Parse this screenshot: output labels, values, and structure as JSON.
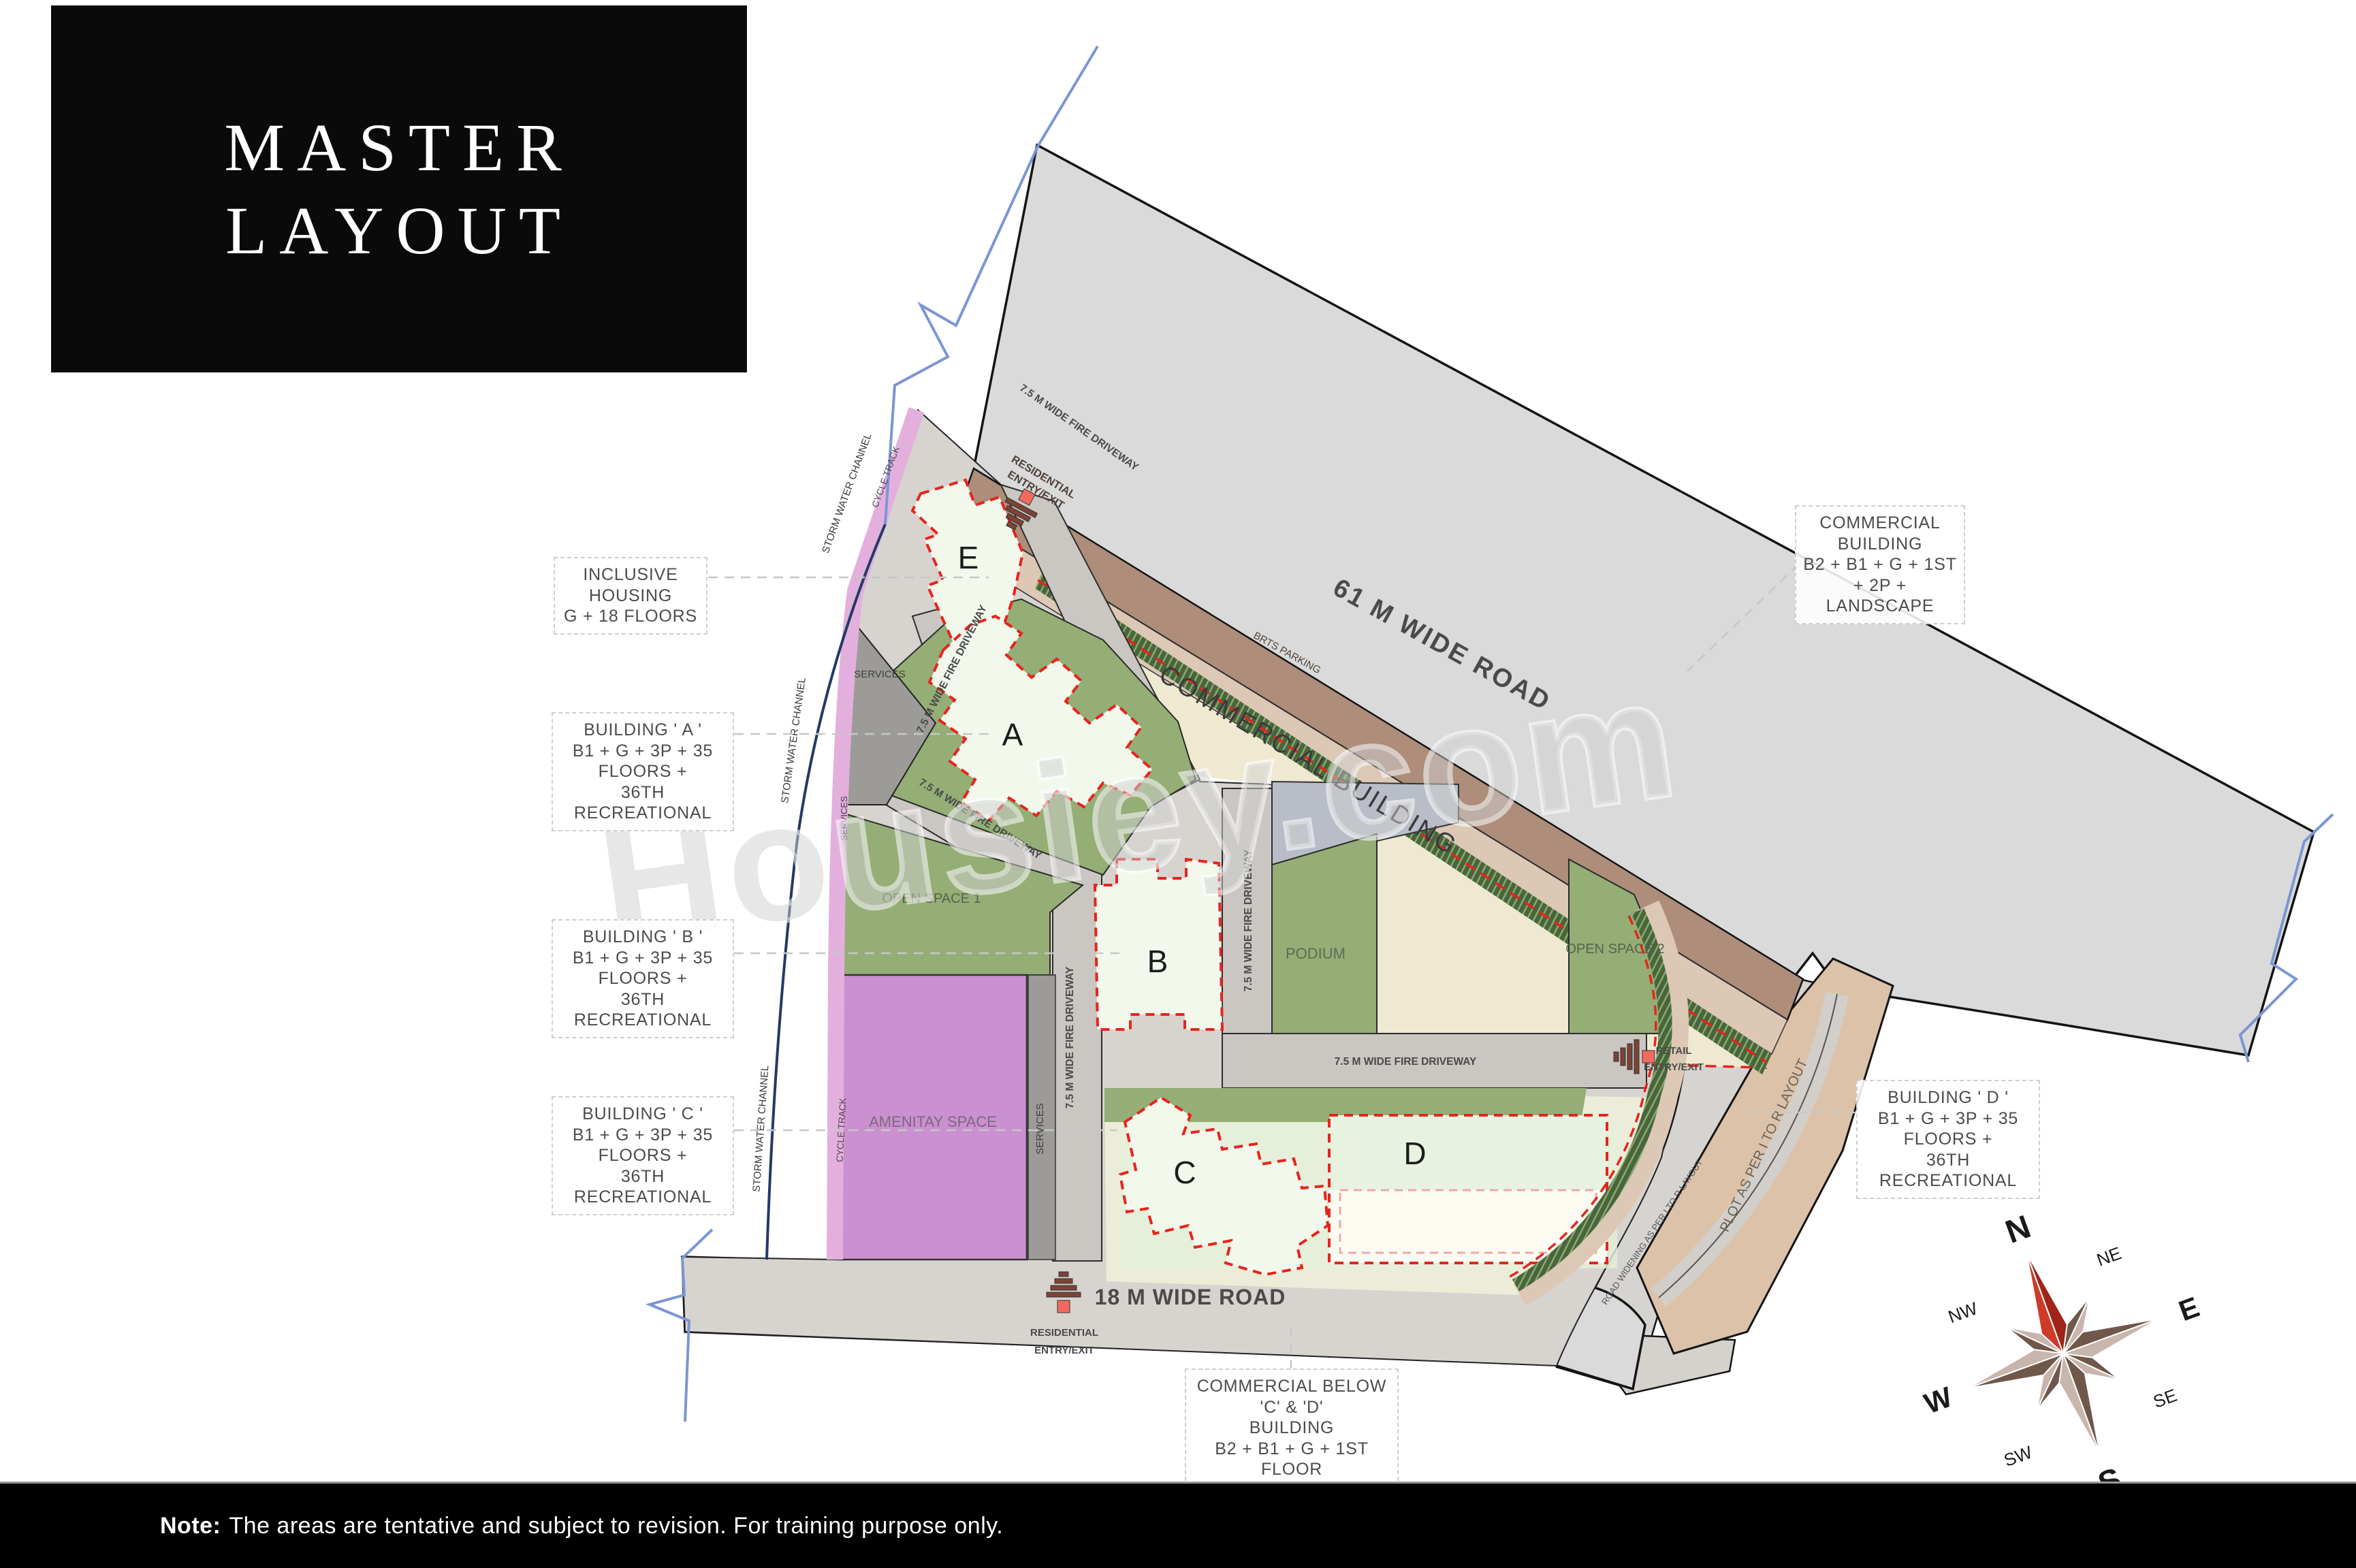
{
  "title": {
    "line1": "MASTER",
    "line2": "LAYOUT"
  },
  "note": {
    "label": "Note:",
    "text": "The areas are tentative and subject to revision. For training purpose only."
  },
  "watermark": "Housiey.com",
  "callouts": {
    "inclusive_housing": {
      "line1": "INCLUSIVE HOUSING",
      "line2": "G + 18 FLOORS"
    },
    "building_a": {
      "line1": "BUILDING ' A '",
      "line2": "B1 + G + 3P + 35 FLOORS +",
      "line3": "36TH RECREATIONAL"
    },
    "building_b": {
      "line1": "BUILDING ' B '",
      "line2": "B1 + G + 3P + 35 FLOORS +",
      "line3": "36TH RECREATIONAL"
    },
    "building_c": {
      "line1": "BUILDING ' C '",
      "line2": "B1 + G + 3P + 35 FLOORS +",
      "line3": "36TH RECREATIONAL"
    },
    "building_d": {
      "line1": "BUILDING ' D '",
      "line2": "B1 + G + 3P + 35 FLOORS +",
      "line3": "36TH RECREATIONAL"
    },
    "commercial": {
      "line1": "COMMERCIAL BUILDING",
      "line2": "B2 + B1 + G + 1ST + 2P +",
      "line3": "LANDSCAPE"
    },
    "commercial_below": {
      "line1": "COMMERCIAL BELOW 'C' & 'D'",
      "line2": "BUILDING",
      "line3": "B2 + B1 + G + 1ST FLOOR"
    }
  },
  "roads": {
    "road61": "61 M WIDE ROAD",
    "road18": "18 M WIDE ROAD",
    "brts": "BRTS PARKING",
    "road_widening": "ROAD WIDENING AS PER I TO R LAYOUT"
  },
  "zones": {
    "commercial_building": "COMMERCIAL BUILDING",
    "podium": "PODIUM",
    "open_space_1": "OPEN SPACE 1",
    "open_space_2": "OPEN SPACE 2",
    "amenity": "AMENITAY SPACE",
    "plot_tor": "PLOT AS PER I TO R LAYOUT",
    "services": "SERVICES",
    "storm_water": "STORM WATER CHANNEL",
    "cycle_track": "CYCLE TRACK",
    "fire_driveway": "7.5 M WIDE FIRE DRIVEWAY"
  },
  "buildings": {
    "a": "A",
    "b": "B",
    "c": "C",
    "d": "D",
    "e": "E"
  },
  "markers": {
    "residential": {
      "line1": "RESIDENTIAL",
      "line2": "ENTRY/EXIT"
    },
    "retail": {
      "line1": "RETAIL",
      "line2": "ENTRY/EXIT"
    }
  },
  "compass": {
    "n": "N",
    "ne": "NE",
    "e": "E",
    "se": "SE",
    "s": "S",
    "sw": "SW",
    "w": "W",
    "nw": "NW"
  },
  "colors": {
    "road_gray": "#dadada",
    "brown_strip": "#ae8d7b",
    "tan_strip": "#dcc8b5",
    "green": "#94ae76",
    "cream": "#efe9d2",
    "amenity_purple": "#ca90d0",
    "cycle_pink": "#e3b0de",
    "boundary_red": "#e8231c",
    "north_red": "#cf3a28",
    "tree_green": "#48663a",
    "tan_plot": "#dcc2a9"
  }
}
